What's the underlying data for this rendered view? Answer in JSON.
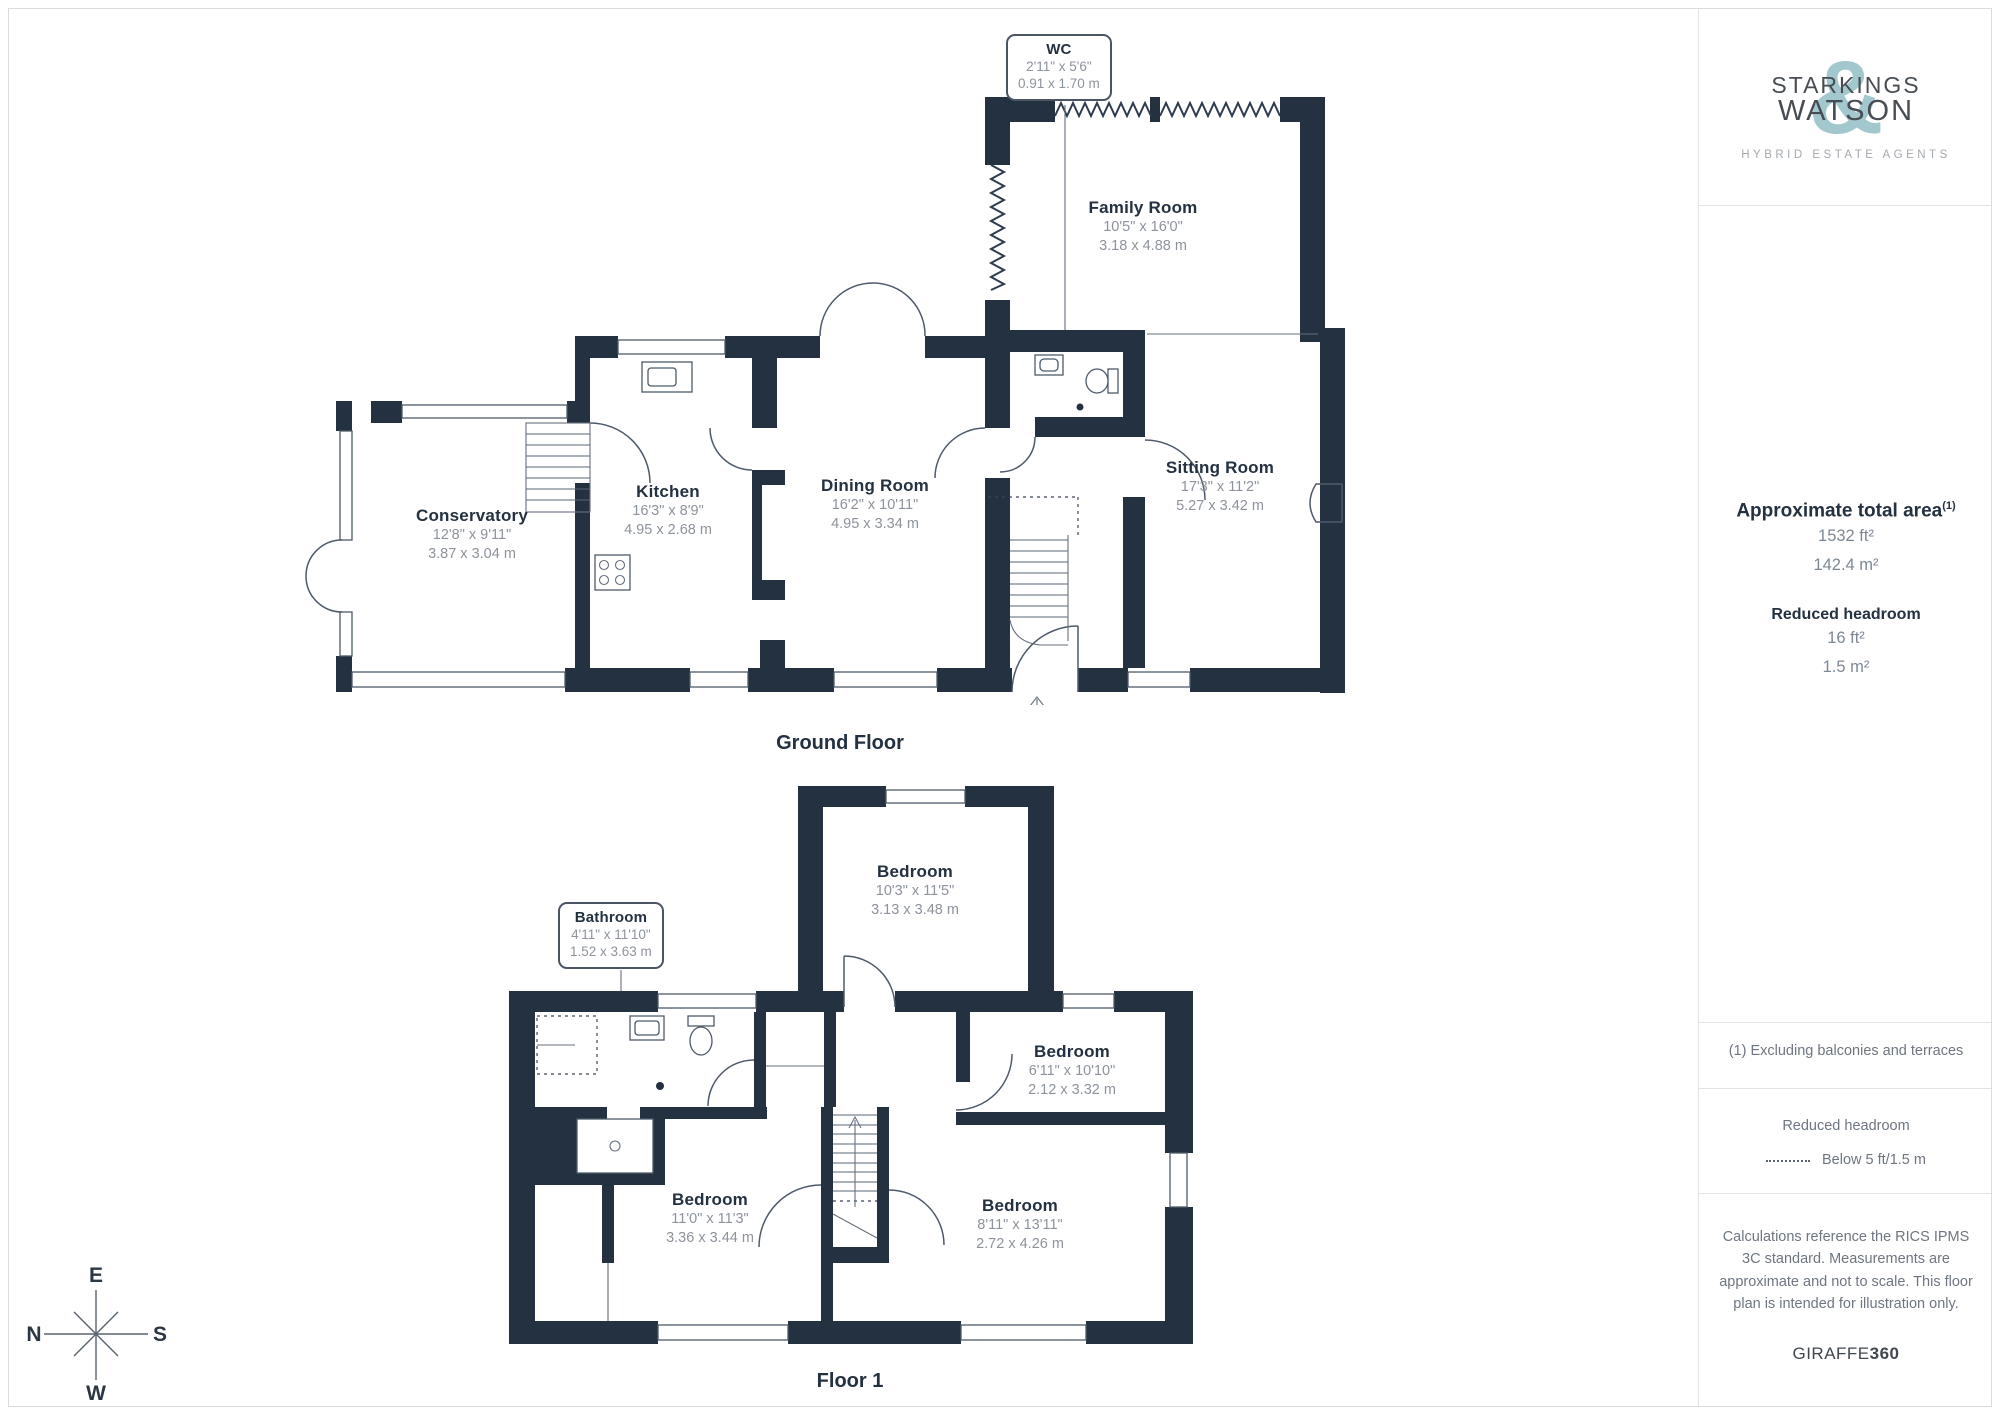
{
  "branding": {
    "name_line1": "STARKINGS",
    "name_line2": "WATSON",
    "ampersand": "&",
    "tagline": "HYBRID ESTATE AGENTS"
  },
  "sidebar": {
    "area_title": "Approximate total area",
    "area_superscript": "(1)",
    "area_ft": "1532 ft²",
    "area_m": "142.4 m²",
    "headroom_title": "Reduced headroom",
    "headroom_ft": "16 ft²",
    "headroom_m": "1.5 m²",
    "footnote": "(1) Excluding balconies and terraces",
    "legend_title": "Reduced headroom",
    "legend_label": "Below 5 ft/1.5 m",
    "disclaimer": "Calculations reference the RICS IPMS 3C standard. Measurements are approximate and not to scale. This floor plan is intended for illustration only.",
    "provider": "GIRAFFE",
    "provider_suffix": "360"
  },
  "floors": [
    {
      "name": "Ground Floor",
      "rooms": [
        {
          "name": "Conservatory",
          "imperial": "12'8\" x 9'11\"",
          "metric": "3.87 x 3.04 m"
        },
        {
          "name": "Kitchen",
          "imperial": "16'3\" x 8'9\"",
          "metric": "4.95 x 2.68 m"
        },
        {
          "name": "Dining Room",
          "imperial": "16'2\" x 10'11\"",
          "metric": "4.95 x 3.34 m"
        },
        {
          "name": "Family Room",
          "imperial": "10'5\" x 16'0\"",
          "metric": "3.18 x 4.88 m"
        },
        {
          "name": "Sitting Room",
          "imperial": "17'3\" x 11'2\"",
          "metric": "5.27 x 3.42 m"
        },
        {
          "name": "WC",
          "imperial": "2'11\" x 5'6\"",
          "metric": "0.91 x 1.70 m"
        }
      ]
    },
    {
      "name": "Floor 1",
      "rooms": [
        {
          "name": "Bedroom",
          "imperial": "10'3\" x 11'5\"",
          "metric": "3.13 x 3.48 m"
        },
        {
          "name": "Bedroom",
          "imperial": "6'11\" x 10'10\"",
          "metric": "2.12 x 3.32 m"
        },
        {
          "name": "Bedroom",
          "imperial": "11'0\" x 11'3\"",
          "metric": "3.36 x 3.44 m"
        },
        {
          "name": "Bedroom",
          "imperial": "8'11\" x 13'11\"",
          "metric": "2.72 x 4.26 m"
        },
        {
          "name": "Bathroom",
          "imperial": "4'11\" x 11'10\"",
          "metric": "1.52 x 3.63 m"
        }
      ]
    }
  ],
  "compass": {
    "top": "E",
    "left": "N",
    "right": "S",
    "bottom": "W"
  },
  "colors": {
    "wall": "#243140",
    "line": "#4e5a6a",
    "accent": "#a2c8ce",
    "dim_text": "#8d939c",
    "label_text": "#233140"
  }
}
